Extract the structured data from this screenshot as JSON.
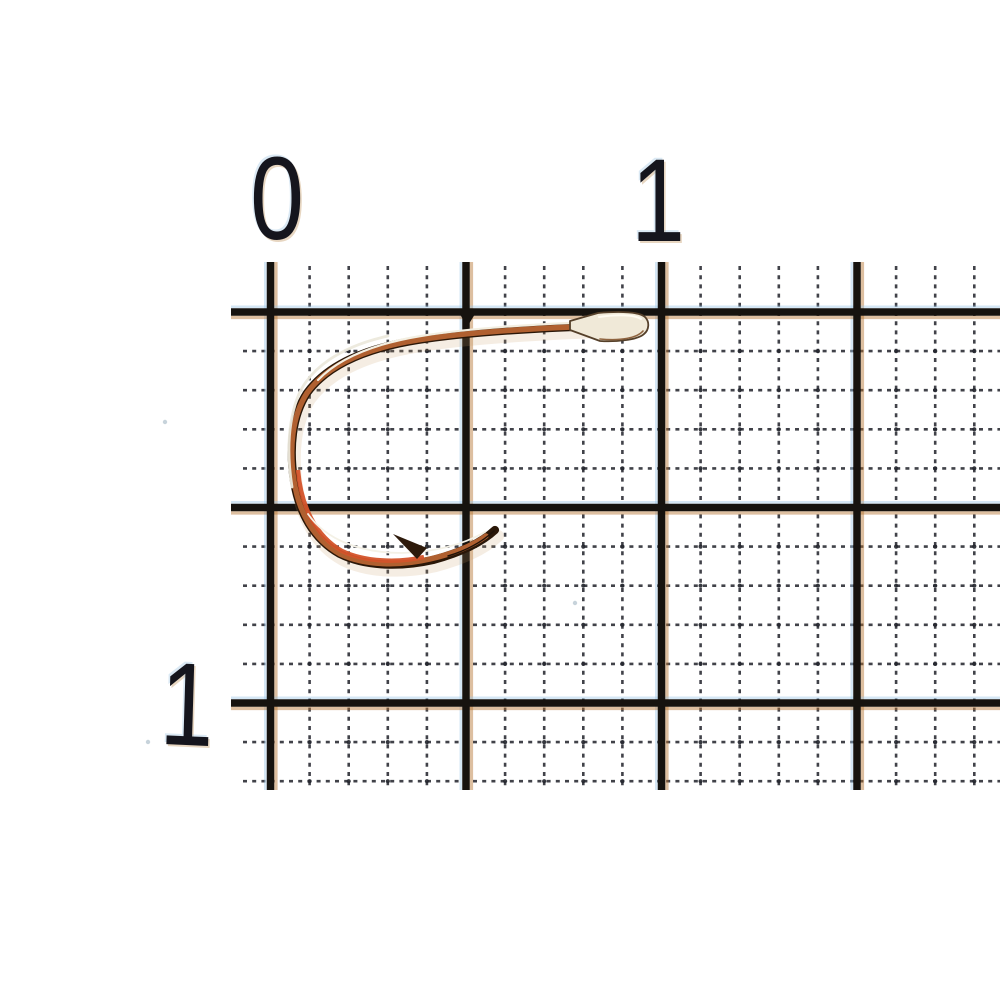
{
  "scene": {
    "description": "macro photo of a fishing hook lying on millimeter graph paper",
    "background": "#ffffff"
  },
  "ruler": {
    "top_labels": [
      {
        "text": "0"
      },
      {
        "text": "1"
      }
    ],
    "left_labels": [
      {
        "text": "1"
      }
    ],
    "label_color": "#15151d",
    "units": "cm"
  },
  "grid": {
    "origin_x": 270.5,
    "origin_y": 312,
    "cell": 39.1,
    "cols": 19,
    "rows": 13,
    "thick_every": 5,
    "tick_top": 262,
    "mm_top": 266,
    "bottom": 790,
    "thick_left": 231,
    "mm_left": 243,
    "right": 1002,
    "thick_width": 7.5,
    "mm_width": 2.6,
    "thick_color": "#16130f",
    "mm_color": "#272931",
    "dot_color": "#20222a",
    "halo_cyan": "#9cc8e8",
    "halo_orange": "#b5722f",
    "dash": "4 5.2",
    "notch": {
      "x": 467,
      "y": 314
    },
    "specks": [
      [
        165,
        422
      ],
      [
        148,
        742
      ],
      [
        575,
        603
      ]
    ]
  },
  "hook": {
    "subject": "spade-end fishing hook, copper/bronze finish with silver sheen",
    "finish_colors": {
      "dark_edge": "#2a1708",
      "copper": "#b06030",
      "red_bend": "#d4532a",
      "silver_highlight": "#f3efe2",
      "spade": "#f0e9d8"
    },
    "paths": [
      {
        "name": "hook-shadow",
        "d": "M 596 326 C 541 328 468 332 418 340 C 367 348 328 364 307 393 C 292 416 289 448 294 481 C 299 512 313 539 340 554 C 366 567 402 567 433 560 C 459 553 480 544 495 530",
        "stroke": "#c79a66",
        "width": 12,
        "cap": "round",
        "opacity": 0.18,
        "transform": "translate(3,6)"
      },
      {
        "name": "hook-wire-base",
        "d": "M 596 326 C 541 328 468 332 418 340 C 367 348 328 364 307 393 C 292 416 289 448 294 481 C 299 512 313 539 340 554 C 366 567 402 567 433 560 C 459 553 480 544 495 530",
        "stroke": "#2a1708",
        "width": 8.2,
        "cap": "round"
      },
      {
        "name": "hook-wire-copper",
        "d": "M 596 326 C 541 328 468 332 418 340 C 367 348 328 364 307 393 C 292 416 289 448 294 481 C 299 512 313 539 340 554 C 366 566 400 566 430 559 C 452 554 472 546 486 536",
        "stroke": "#b06030",
        "width": 5.4,
        "cap": "round"
      },
      {
        "name": "hook-bend-red",
        "d": "M 298 470 C 301 507 316 536 342 551 C 365 562 398 563 424 557",
        "stroke": "#d4532a",
        "width": 4.4,
        "cap": "butt",
        "opacity": 0.95
      },
      {
        "name": "hook-outer-silver",
        "d": "M 388 336 C 342 346 308 368 297 399 C 288 424 287 455 292 487",
        "stroke": "#ece9dc",
        "width": 2.8,
        "cap": "round",
        "opacity": 0.95
      },
      {
        "name": "hook-shank-highlight",
        "d": "M 592 322 C 540 324 470 328 421 336 C 378 343 341 356 318 380",
        "stroke": "#f3efe2",
        "width": 2.2,
        "cap": "round"
      },
      {
        "name": "hook-point-highlight",
        "d": "M 308 514 C 326 540 361 553 402 553 C 436 552 464 544 485 532",
        "stroke": "#f4f1e6",
        "width": 1.8,
        "cap": "round"
      },
      {
        "name": "hook-point-dark-edge",
        "d": "M 448 556 C 468 550 483 541 494 531",
        "stroke": "#1f1208",
        "width": 1.5,
        "cap": "round"
      },
      {
        "name": "hook-barb",
        "d": "M 393 534 L 427 548 L 417 559 Z",
        "fill": "#2e1a0b"
      },
      {
        "name": "hook-spade",
        "d": "M 570 321 L 598 313 C 621 311 640 312 645 317 C 650 322 649 330 644 334 C 638 340 615 342 600 341 L 570 330 Z",
        "fill": "#f0e9d8",
        "stroke": "#55402a",
        "width": 1.8
      },
      {
        "name": "hook-spade-shadow",
        "d": "M 600 339 C 621 341 637 338 643 331",
        "stroke": "#8f6440",
        "width": 1.6,
        "cap": "round"
      },
      {
        "name": "hook-spade-sheen",
        "d": "M 599 317 C 619 314 635 315 641 319",
        "stroke": "#fffdf4",
        "width": 2,
        "cap": "round",
        "opacity": 0.9
      }
    ]
  }
}
